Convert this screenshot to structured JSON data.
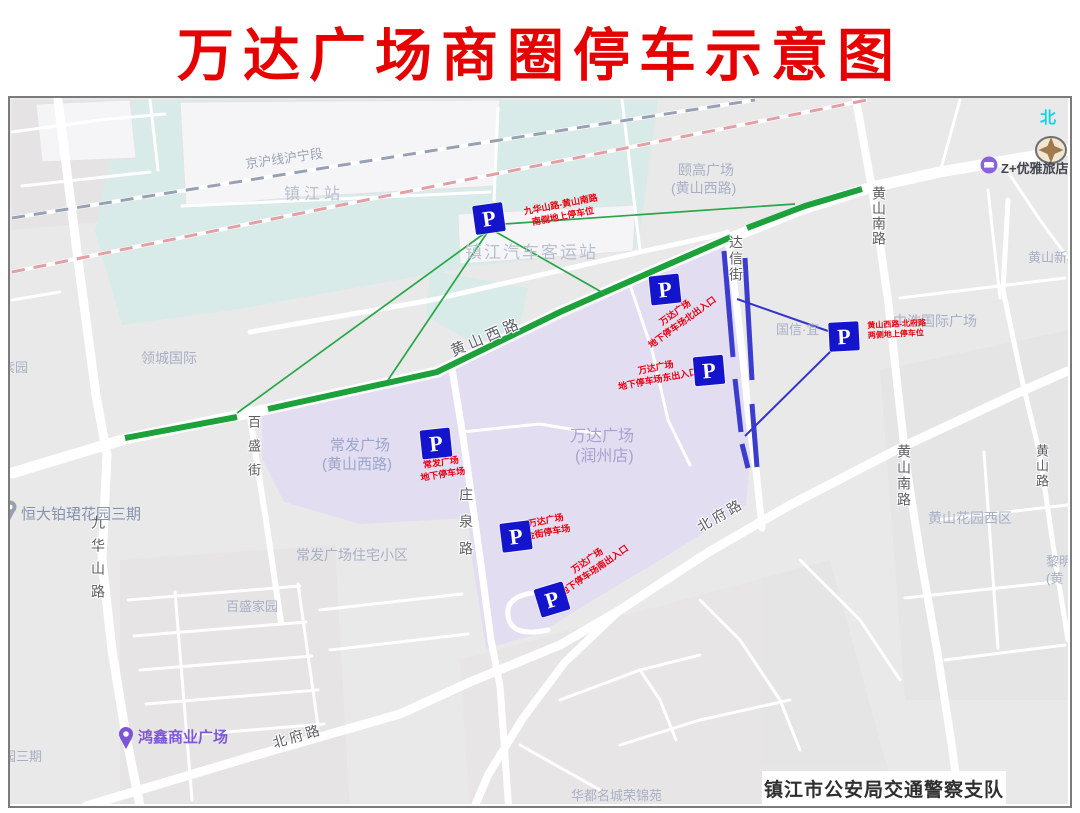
{
  "title": "万达广场商圈停车示意图",
  "credit": "镇江市公安局交通警察支队",
  "compass": {
    "north": "北"
  },
  "parking": {
    "letter": "P"
  },
  "colors": {
    "title_red": "#e60000",
    "note_red": "#e8000f",
    "parking_blue": "#1414cc",
    "roadside_green": "#1ca13b",
    "street_parking_blue": "#3c3ccd",
    "plaza_lavender": "#e3ddf2",
    "station_teal": "#d9ebe8"
  },
  "notes": {
    "jiuhuashan_south": {
      "line1": "九华山路-黄山南路",
      "line2": "南侧地上停车位"
    },
    "wanda_north": {
      "line1": "万达广场",
      "line2": "地下停车场北出入口"
    },
    "wanda_east": {
      "line1": "万达广场",
      "line2": "地下停车场东出入口"
    },
    "changfa_underground": {
      "line1": "常发广场",
      "line2": "地下停车场"
    },
    "wanda_goldstreet": {
      "line1": "万达广场",
      "line2": "金街停车场"
    },
    "wanda_south": {
      "line1": "万达广场",
      "line2": "地下停车场南出入口"
    },
    "huangshanxi_beifu": {
      "line1": "黄山西路-北府路",
      "line2": "两侧地上停车位"
    }
  },
  "roads": {
    "railway": "京沪线沪宁段",
    "huangshan_west": "黄山西路",
    "jiuhuashan": "九华山路",
    "baisheng_street": "百盛街",
    "zhuangquan": "庄泉路",
    "daxin_street": "达信街",
    "huangshan_south": "黄山南路",
    "huangshan_road": "黄山路",
    "beifu": "北府路"
  },
  "places": {
    "zhenjiang_station": "镇江站",
    "bus_station": "镇江汽车客运站",
    "yigao_plaza_1": "颐高广场",
    "yigao_plaza_2": "(黄山西路)",
    "ziyuan": "紫园",
    "lingcheng": "领城国际",
    "hengda": "恒大铂珺花园三期",
    "changfa_plaza_1": "常发广场",
    "changfa_plaza_2": "(黄山西路)",
    "changfa_residential": "常发广场住宅小区",
    "baisheng_homeland": "百盛家园",
    "wanda_plaza_1": "万达广场",
    "wanda_plaza_2": "(润州店)",
    "guoxin": "国信·宜",
    "zhonghao": "中浩国际广场",
    "huangshan_xincun": "黄山新村",
    "hotel": "Z+优雅旅店",
    "huangshan_garden_west": "黄山花园西区",
    "liming_1": "黎明",
    "liming_2": "(黄",
    "zeyuan": "泽园三期",
    "hongxin": "鸿鑫商业广场",
    "huadu": "华都名城荣锦苑"
  }
}
